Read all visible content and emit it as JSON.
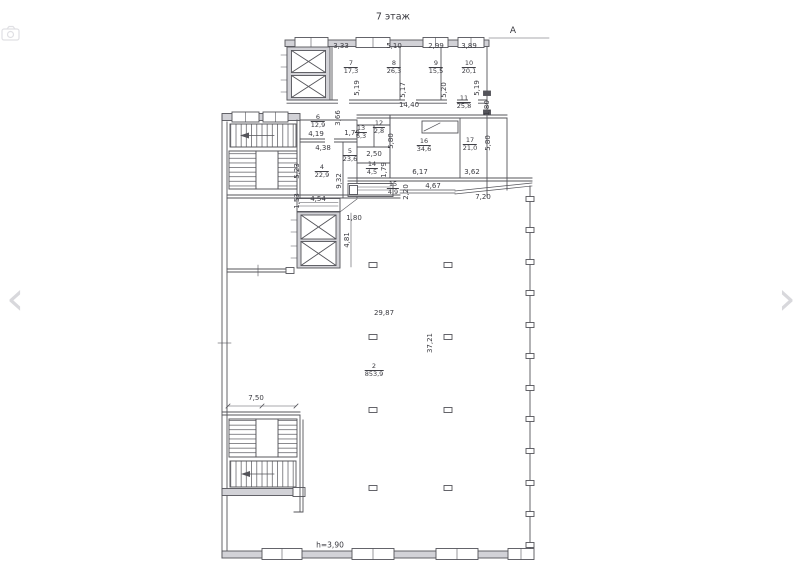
{
  "viewer": {
    "prev_label": "‹",
    "next_label": "›"
  },
  "colors": {
    "line": "#54545a",
    "wall_fill": "#d2d2d7",
    "nav_arrow": "#d8d8dc"
  },
  "drawing": {
    "title": "7 этаж",
    "axis_label": "А",
    "height_note": "h=3,90",
    "rooms": [
      {
        "num": "7",
        "area": "17,3",
        "x": 351,
        "y": 68
      },
      {
        "num": "8",
        "area": "26,3",
        "x": 394,
        "y": 68
      },
      {
        "num": "9",
        "area": "15,5",
        "x": 436,
        "y": 68
      },
      {
        "num": "10",
        "area": "20,1",
        "x": 469,
        "y": 68
      },
      {
        "num": "11",
        "area": "25,8",
        "x": 464,
        "y": 103
      },
      {
        "num": "6",
        "area": "12,9",
        "x": 318,
        "y": 122
      },
      {
        "num": "12",
        "area": "2,8",
        "x": 379,
        "y": 128
      },
      {
        "num": "13",
        "area": "6,3",
        "x": 361,
        "y": 133
      },
      {
        "num": "16",
        "area": "34,6",
        "x": 424,
        "y": 146
      },
      {
        "num": "17",
        "area": "21,0",
        "x": 470,
        "y": 145
      },
      {
        "num": "5",
        "area": "23,6",
        "x": 350,
        "y": 156
      },
      {
        "num": "4",
        "area": "22,9",
        "x": 322,
        "y": 172
      },
      {
        "num": "14",
        "area": "4,5",
        "x": 372,
        "y": 169
      },
      {
        "num": "15",
        "area": "4,9",
        "x": 393,
        "y": 189
      },
      {
        "num": "2",
        "area": "853,9",
        "x": 374,
        "y": 371
      }
    ],
    "dims_h": [
      {
        "t": "3,33",
        "x": 341,
        "y": 46
      },
      {
        "t": "5,10",
        "x": 394,
        "y": 46
      },
      {
        "t": "2,99",
        "x": 436,
        "y": 46
      },
      {
        "t": "3,89",
        "x": 469,
        "y": 46
      },
      {
        "t": "14,40",
        "x": 409,
        "y": 105
      },
      {
        "t": "4,19",
        "x": 316,
        "y": 134
      },
      {
        "t": "1,79",
        "x": 352,
        "y": 133
      },
      {
        "t": "4,38",
        "x": 323,
        "y": 148
      },
      {
        "t": "2,50",
        "x": 374,
        "y": 154
      },
      {
        "t": "6,17",
        "x": 420,
        "y": 172
      },
      {
        "t": "3,62",
        "x": 472,
        "y": 172
      },
      {
        "t": "4,67",
        "x": 433,
        "y": 186
      },
      {
        "t": "7,20",
        "x": 483,
        "y": 197
      },
      {
        "t": "4,54",
        "x": 318,
        "y": 199
      },
      {
        "t": "1,80",
        "x": 354,
        "y": 218
      },
      {
        "t": "29,87",
        "x": 384,
        "y": 313
      },
      {
        "t": "7,50",
        "x": 256,
        "y": 398
      }
    ],
    "dims_v": [
      {
        "t": "5,19",
        "x": 357,
        "y": 88
      },
      {
        "t": "5,17",
        "x": 403,
        "y": 90
      },
      {
        "t": "5,20",
        "x": 444,
        "y": 90
      },
      {
        "t": "5,19",
        "x": 477,
        "y": 88
      },
      {
        "t": "1,80",
        "x": 487,
        "y": 108
      },
      {
        "t": "3,66",
        "x": 338,
        "y": 118
      },
      {
        "t": "5,80",
        "x": 391,
        "y": 141
      },
      {
        "t": "5,80",
        "x": 488,
        "y": 143
      },
      {
        "t": "5,23",
        "x": 297,
        "y": 171
      },
      {
        "t": "1,79",
        "x": 384,
        "y": 170
      },
      {
        "t": "9,32",
        "x": 339,
        "y": 181
      },
      {
        "t": "2,20",
        "x": 406,
        "y": 192
      },
      {
        "t": "1,53",
        "x": 297,
        "y": 201
      },
      {
        "t": "4,81",
        "x": 347,
        "y": 240
      },
      {
        "t": "37,21",
        "x": 430,
        "y": 343
      }
    ]
  }
}
